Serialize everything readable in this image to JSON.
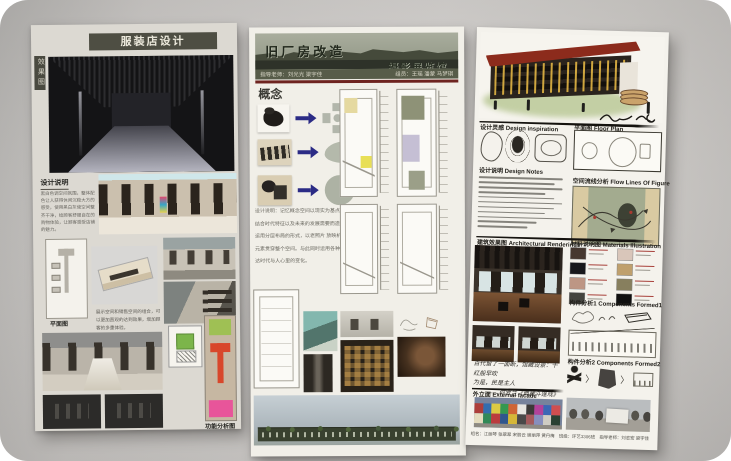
{
  "left_board": {
    "title": "服装店设计",
    "side_label": "效果图",
    "design_notes_heading": "设计说明",
    "design_notes_text": "黑白色调空间氛围，整体配色让人获得休闲沉稳大方的感受，使用黑白灰使空间整齐干净，给顾客舒服自在的购物体验，让顾客感受店铺的魅力。",
    "plan_label": "平面图",
    "note_text": "展示空间和销售空间的组合，可以更加直观的达到效果，增加顾客的多重体验。",
    "function_label": "功能分析图"
  },
  "middle_board": {
    "title": "旧厂房改造",
    "subtitle": "摄影展览馆",
    "advisors": "指导老师：刘光光 梁宇佳",
    "team": "组员：王瑶 潘蒙 马梦琪",
    "concept_heading": "概念",
    "design_lines": [
      "设计说明：记忆概念空间以现实为基点。",
      "结合时代特征以及未来的发展需要而造成的空间。",
      "运用分层布局的形式，以老照片 放映机为主要",
      "元素贯穿整个空间。与此同时运用各种颜色来表",
      "达时代与人心里的变化。"
    ]
  },
  "right_board": {
    "headings": {
      "inspiration": "设计灵感 Design inspiration",
      "floor_plan": "平面图 Floor Plan",
      "design_notes": "设计说明 Design Notes",
      "flow": "空间流线分析 Flow Lines Of Figure",
      "renderings": "建筑效果图 Architectural Renderings",
      "materials": "材料说明图 Materials Illustration",
      "components1": "构件分析1 Components Formed1",
      "components2": "构件分析2 Components Formed2",
      "facade": "外立面 External facade"
    },
    "quote_lines": [
      "百代留了一面断，馆藏设景：千红般早吹",
      "为是，民是主人",
      "——何罗兰《典藏斗篷戏》"
    ],
    "credits": "组名：江丽琴 张翠翠 宋丽云 谢丽萍 黄丹梅　班级：环艺3306班　指导老师：刘志宏 梁宇佳　学校：设计艺术学院",
    "material_colors": [
      "#463830",
      "#d9c6ba",
      "#17171b",
      "#bfa06d",
      "#bd9684",
      "#877f5e",
      "#44443f",
      "#101010"
    ],
    "mosaic_colors": [
      "#b23630",
      "#2b6ab0",
      "#e8d23a",
      "#2e9a48",
      "#d8622a",
      "#f2efe8",
      "#35322e",
      "#b83a9a",
      "#3464b8",
      "#d84848",
      "#efe6c2",
      "#2a8a50",
      "#c23434",
      "#28518c",
      "#e0bc2e",
      "#454240",
      "#a85555",
      "#8890c2",
      "#d8d4c8",
      "#203a28"
    ]
  },
  "zones": {
    "green": "#9fc054",
    "red": "#d8472b",
    "pink": "#e8559a"
  }
}
